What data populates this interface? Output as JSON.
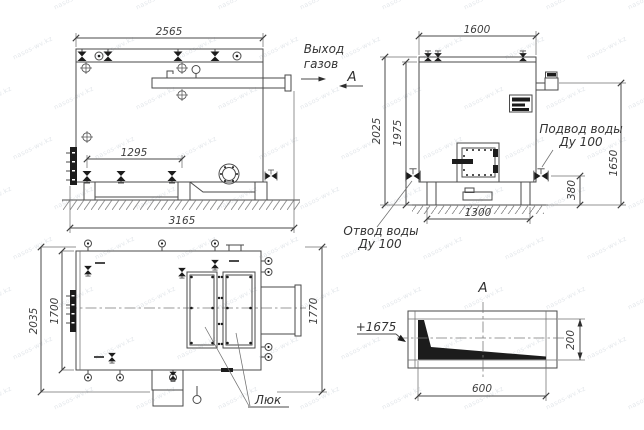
{
  "watermark": "nasos-wv.kz",
  "side_view": {
    "dims": {
      "top_width": "2565",
      "valve_span": "1295",
      "total_length": "3165"
    }
  },
  "front_view": {
    "dims": {
      "width": "1600",
      "height_outer": "2025",
      "height_inner": "1975",
      "chimney_height": "1650",
      "valve_height": "380",
      "base_width": "1300"
    },
    "labels": {
      "gas_outlet_line1": "Выход",
      "gas_outlet_line2": "газов",
      "section_mark": "А",
      "water_supply_line1": "Подвод воды",
      "water_supply_line2": "Ду 100",
      "water_return_line1": "Отвод воды",
      "water_return_line2": "Ду 100"
    }
  },
  "plan_view": {
    "dims": {
      "outer_width": "2035",
      "body_width": "1700",
      "right_width": "1770"
    },
    "labels": {
      "hatch": "Люк"
    }
  },
  "section_view": {
    "title": "А",
    "labels": {
      "elevation": "+1675"
    },
    "dims": {
      "width": "600",
      "height": "200"
    }
  }
}
